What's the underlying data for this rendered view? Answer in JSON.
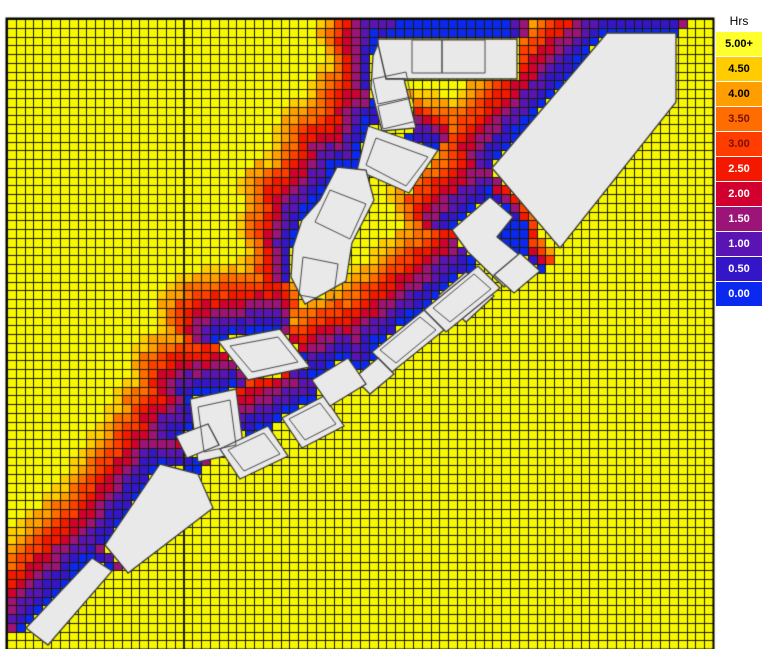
{
  "legend": {
    "title": "Hrs",
    "entries": [
      {
        "label": "5.00+",
        "color": "#FFFF2E",
        "text_color": "#000000"
      },
      {
        "label": "4.50",
        "color": "#FFCC00",
        "text_color": "#000000"
      },
      {
        "label": "4.00",
        "color": "#FF9E00",
        "text_color": "#000000"
      },
      {
        "label": "3.50",
        "color": "#FF6D00",
        "text_color": "#7A1000"
      },
      {
        "label": "3.00",
        "color": "#FF3D00",
        "text_color": "#7A1000"
      },
      {
        "label": "2.50",
        "color": "#F51800",
        "text_color": "#FFFFFF"
      },
      {
        "label": "2.00",
        "color": "#D1002F",
        "text_color": "#FFFFFF"
      },
      {
        "label": "1.50",
        "color": "#9C1478",
        "text_color": "#FFFFFF"
      },
      {
        "label": "1.00",
        "color": "#5A14B4",
        "text_color": "#FFFFFF"
      },
      {
        "label": "0.50",
        "color": "#3415C8",
        "text_color": "#FFFFFF"
      },
      {
        "label": "0.00",
        "color": "#0A28F0",
        "text_color": "#FFFFFF"
      }
    ]
  },
  "chart_data": {
    "type": "heatmap",
    "units": "Hrs",
    "legend_title": "Hrs",
    "bins": [
      {
        "label": "5.00+",
        "color": "#FFFF2E"
      },
      {
        "label": "4.50",
        "color": "#FFCC00"
      },
      {
        "label": "4.00",
        "color": "#FF9E00"
      },
      {
        "label": "3.50",
        "color": "#FF6D00"
      },
      {
        "label": "3.00",
        "color": "#FF3D00"
      },
      {
        "label": "2.50",
        "color": "#F51800"
      },
      {
        "label": "2.00",
        "color": "#D1002F"
      },
      {
        "label": "1.50",
        "color": "#9C1478"
      },
      {
        "label": "1.00",
        "color": "#5A14B4"
      },
      {
        "label": "0.50",
        "color": "#3415C8"
      },
      {
        "label": "0.00",
        "color": "#0A28F0"
      }
    ],
    "color_ramp_low_to_high": [
      "#0A28F0",
      "#3415C8",
      "#5A14B4",
      "#9C1478",
      "#D1002F",
      "#F51800",
      "#FF3D00",
      "#FF6D00",
      "#FF9E00",
      "#FFCC00",
      "#F7F700"
    ],
    "grid": {
      "x": 7,
      "y": 19,
      "width": 706,
      "height": 630,
      "cols": 80,
      "rows": 72,
      "base_hours": 5,
      "line_color": "#1E1E00",
      "base_color": "#F7F700",
      "border_color": "#000000"
    },
    "buildings_style": {
      "fill": "#E9E9E9",
      "stroke": "#3C3C3C",
      "inner_stroke": "#4A4A4A"
    },
    "buildings": [
      {
        "pts": [
          [
            378,
            39
          ],
          [
            517,
            39
          ],
          [
            517,
            79
          ],
          [
            386,
            79
          ],
          [
            378,
            50
          ]
        ],
        "inner": [
          [
            [
              412,
              40
            ],
            [
              442,
              40
            ],
            [
              442,
              73
            ],
            [
              412,
              73
            ]
          ],
          [
            [
              442,
              40
            ],
            [
              485,
              40
            ],
            [
              485,
              73
            ],
            [
              442,
              73
            ]
          ]
        ]
      },
      {
        "pts": [
          [
            378,
            44
          ],
          [
            386,
            79
          ],
          [
            404,
            79
          ],
          [
            416,
            128
          ],
          [
            382,
            131
          ],
          [
            371,
            88
          ],
          [
            373,
            56
          ]
        ],
        "inner": [
          [
            [
              373,
              79
            ],
            [
              406,
              72
            ],
            [
              411,
              97
            ],
            [
              378,
              104
            ]
          ],
          [
            [
              378,
              106
            ],
            [
              412,
              98
            ],
            [
              417,
              121
            ],
            [
              383,
              129
            ]
          ]
        ]
      },
      {
        "pts": [
          [
            368,
            126
          ],
          [
            438,
            150
          ],
          [
            409,
            193
          ],
          [
            357,
            170
          ]
        ],
        "inner": [
          [
            [
              376,
              138
            ],
            [
              428,
              157
            ],
            [
              406,
              186
            ],
            [
              366,
              165
            ]
          ]
        ]
      },
      {
        "pts": [
          [
            607,
            33
          ],
          [
            676,
            33
          ],
          [
            676,
            102
          ],
          [
            560,
            248
          ],
          [
            492,
            168
          ]
        ]
      },
      {
        "pts": [
          [
            452,
            230
          ],
          [
            490,
            197
          ],
          [
            513,
            217
          ],
          [
            497,
            237
          ],
          [
            528,
            262
          ],
          [
            504,
            287
          ],
          [
            468,
            252
          ]
        ]
      },
      {
        "pts": [
          [
            438,
            296
          ],
          [
            466,
            272
          ],
          [
            494,
            296
          ],
          [
            466,
            322
          ]
        ]
      },
      {
        "pts": [
          [
            494,
            275
          ],
          [
            520,
            253
          ],
          [
            540,
            271
          ],
          [
            514,
            293
          ]
        ]
      },
      {
        "pts": [
          [
            424,
            310
          ],
          [
            478,
            266
          ],
          [
            500,
            288
          ],
          [
            446,
            332
          ]
        ],
        "inner": [
          [
            [
              433,
              308
            ],
            [
              474,
              274
            ],
            [
              491,
              289
            ],
            [
              450,
              322
            ]
          ]
        ]
      },
      {
        "pts": [
          [
            372,
            352
          ],
          [
            424,
            310
          ],
          [
            444,
            330
          ],
          [
            392,
            372
          ]
        ],
        "inner": [
          [
            [
              380,
              350
            ],
            [
              420,
              317
            ],
            [
              436,
              330
            ],
            [
              396,
              363
            ]
          ]
        ]
      },
      {
        "pts": [
          [
            354,
            378
          ],
          [
            378,
            358
          ],
          [
            394,
            374
          ],
          [
            370,
            394
          ]
        ]
      },
      {
        "pts": [
          [
            337,
            167
          ],
          [
            366,
            170
          ],
          [
            374,
            200
          ],
          [
            352,
            243
          ],
          [
            346,
            281
          ],
          [
            305,
            304
          ],
          [
            291,
            277
          ],
          [
            293,
            247
          ],
          [
            302,
            220
          ],
          [
            320,
            200
          ]
        ],
        "inner": [
          [
            [
              330,
              190
            ],
            [
              366,
              204
            ],
            [
              350,
              239
            ],
            [
              315,
              222
            ]
          ],
          [
            [
              303,
              257
            ],
            [
              338,
              264
            ],
            [
              333,
              301
            ],
            [
              299,
              295
            ]
          ]
        ]
      },
      {
        "pts": [
          [
            218,
            341
          ],
          [
            280,
            329
          ],
          [
            310,
            367
          ],
          [
            248,
            380
          ]
        ],
        "inner": [
          [
            [
              230,
              346
            ],
            [
              278,
              337
            ],
            [
              298,
              362
            ],
            [
              252,
              372
            ]
          ]
        ]
      },
      {
        "pts": [
          [
            190,
            399
          ],
          [
            236,
            389
          ],
          [
            244,
            452
          ],
          [
            198,
            462
          ]
        ],
        "inner": [
          [
            [
              198,
              407
            ],
            [
              230,
              400
            ],
            [
              236,
              445
            ],
            [
              204,
              452
            ]
          ]
        ]
      },
      {
        "pts": [
          [
            220,
            449
          ],
          [
            268,
            426
          ],
          [
            288,
            456
          ],
          [
            240,
            479
          ]
        ],
        "inner": [
          [
            [
              228,
              450
            ],
            [
              264,
              433
            ],
            [
              280,
              454
            ],
            [
              244,
              471
            ]
          ]
        ]
      },
      {
        "pts": [
          [
            282,
            418
          ],
          [
            324,
            396
          ],
          [
            344,
            426
          ],
          [
            302,
            448
          ]
        ],
        "inner": [
          [
            [
              289,
              419
            ],
            [
              320,
              403
            ],
            [
              336,
              424
            ],
            [
              305,
              440
            ]
          ]
        ]
      },
      {
        "pts": [
          [
            312,
            380
          ],
          [
            348,
            358
          ],
          [
            366,
            384
          ],
          [
            330,
            406
          ]
        ]
      },
      {
        "pts": [
          [
            176,
            436
          ],
          [
            208,
            424
          ],
          [
            219,
            445
          ],
          [
            187,
            458
          ]
        ]
      },
      {
        "pts": [
          [
            160,
            464
          ],
          [
            198,
            474
          ],
          [
            213,
            508
          ],
          [
            128,
            573
          ],
          [
            105,
            545
          ]
        ]
      },
      {
        "pts": [
          [
            26,
            628
          ],
          [
            92,
            558
          ],
          [
            112,
            571
          ],
          [
            48,
            645
          ]
        ]
      }
    ],
    "shading": {
      "range_px": 52,
      "dir_weight_north": 1.35,
      "dir_weight_west": 0.8,
      "max_factor": 1.5,
      "min_factor": 0.15,
      "noise_step": 0.08
    },
    "zero_hour_overrides": [
      {
        "rect": [
          393,
          21,
          506,
          39
        ]
      },
      {
        "rect": [
          496,
          216,
          526,
          258
        ]
      }
    ]
  }
}
